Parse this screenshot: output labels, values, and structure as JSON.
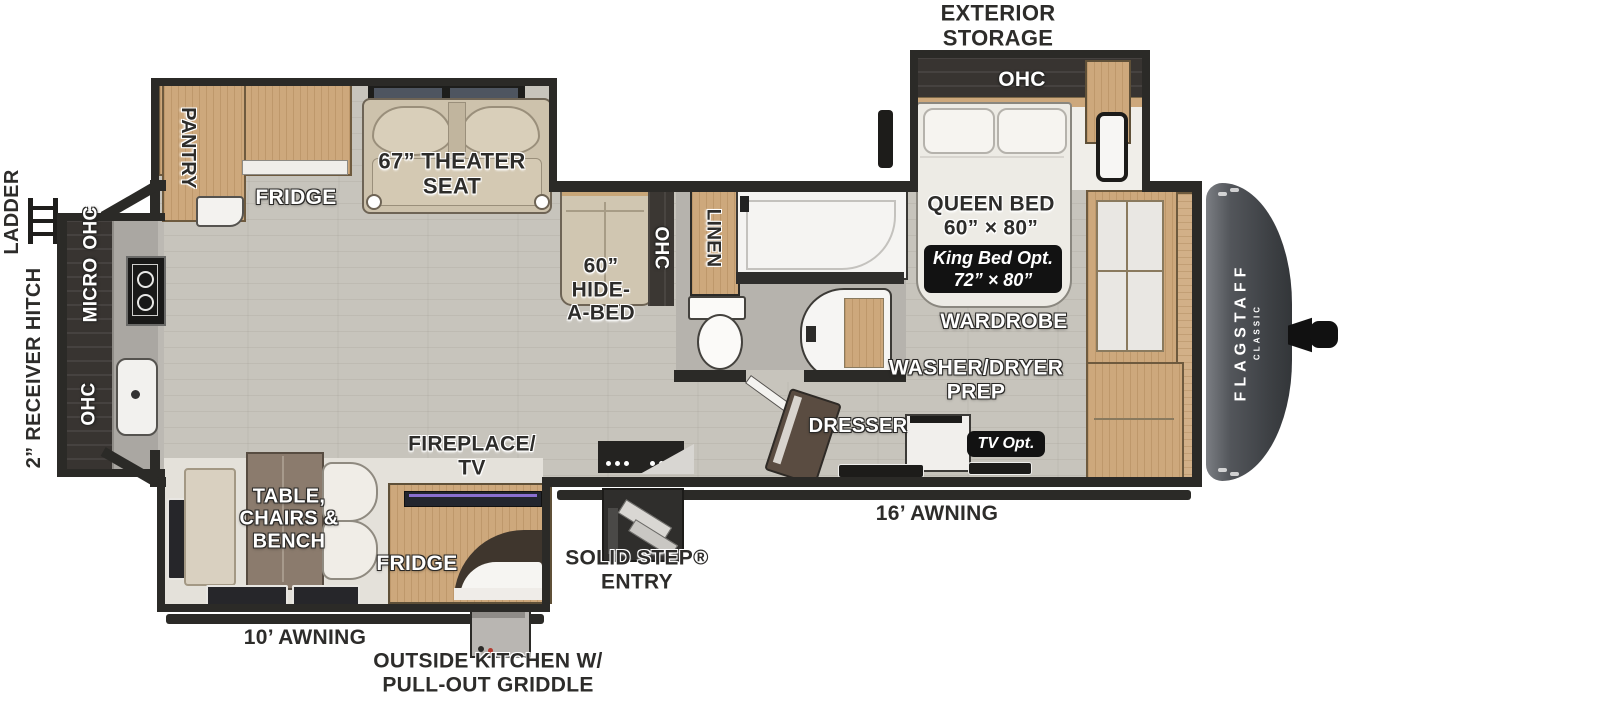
{
  "colors": {
    "wall": "#2b2a27",
    "floor_wood": "#c7c4bc",
    "cabinet_wood": "#cda87c",
    "dark_cabinet": "#383431",
    "seat_beige": "#d0c6b1",
    "badge_bg": "#121212",
    "front_cap": "#45484d",
    "tv_accent": "#8a6fd0"
  },
  "logo": {
    "brand": "FLAGSTAFF",
    "series": "CLASSIC"
  },
  "exterior": {
    "exterior_storage": "EXTERIOR\nSTORAGE",
    "ladder": "LADDER",
    "receiver_hitch": "2” RECEIVER HITCH",
    "awning_16": "16’ AWNING",
    "awning_10": "10’ AWNING",
    "outside_kitchen": "OUTSIDE KITCHEN W/\nPULL-OUT GRIDDLE",
    "solid_step_entry": "SOLID STEP®\nENTRY"
  },
  "bedroom": {
    "ohc": "OHC",
    "queen_bed": "QUEEN BED\n60” × 80”",
    "king_bed_opt": "King Bed Opt.\n72” × 80”",
    "wardrobe": "WARDROBE",
    "washer_dryer_prep": "WASHER/DRYER\nPREP",
    "tv_opt": "TV Opt.",
    "dresser": "DRESSER"
  },
  "bath": {
    "linen": "LINEN"
  },
  "living": {
    "pantry": "PANTRY",
    "fridge": "FRIDGE",
    "theater_seat": "67” THEATER\nSEAT",
    "hide_a_bed": "60”\nHIDE-\nA-BED",
    "ohc_sofa": "OHC",
    "fireplace_tv": "FIREPLACE/\nTV",
    "table_chairs_bench": "TABLE,\nCHAIRS &\nBENCH",
    "fridge_outside": "FRIDGE"
  },
  "kitchen": {
    "ohc_upper": "OHC",
    "micro": "MICRO",
    "ohc_lower": "OHC"
  }
}
